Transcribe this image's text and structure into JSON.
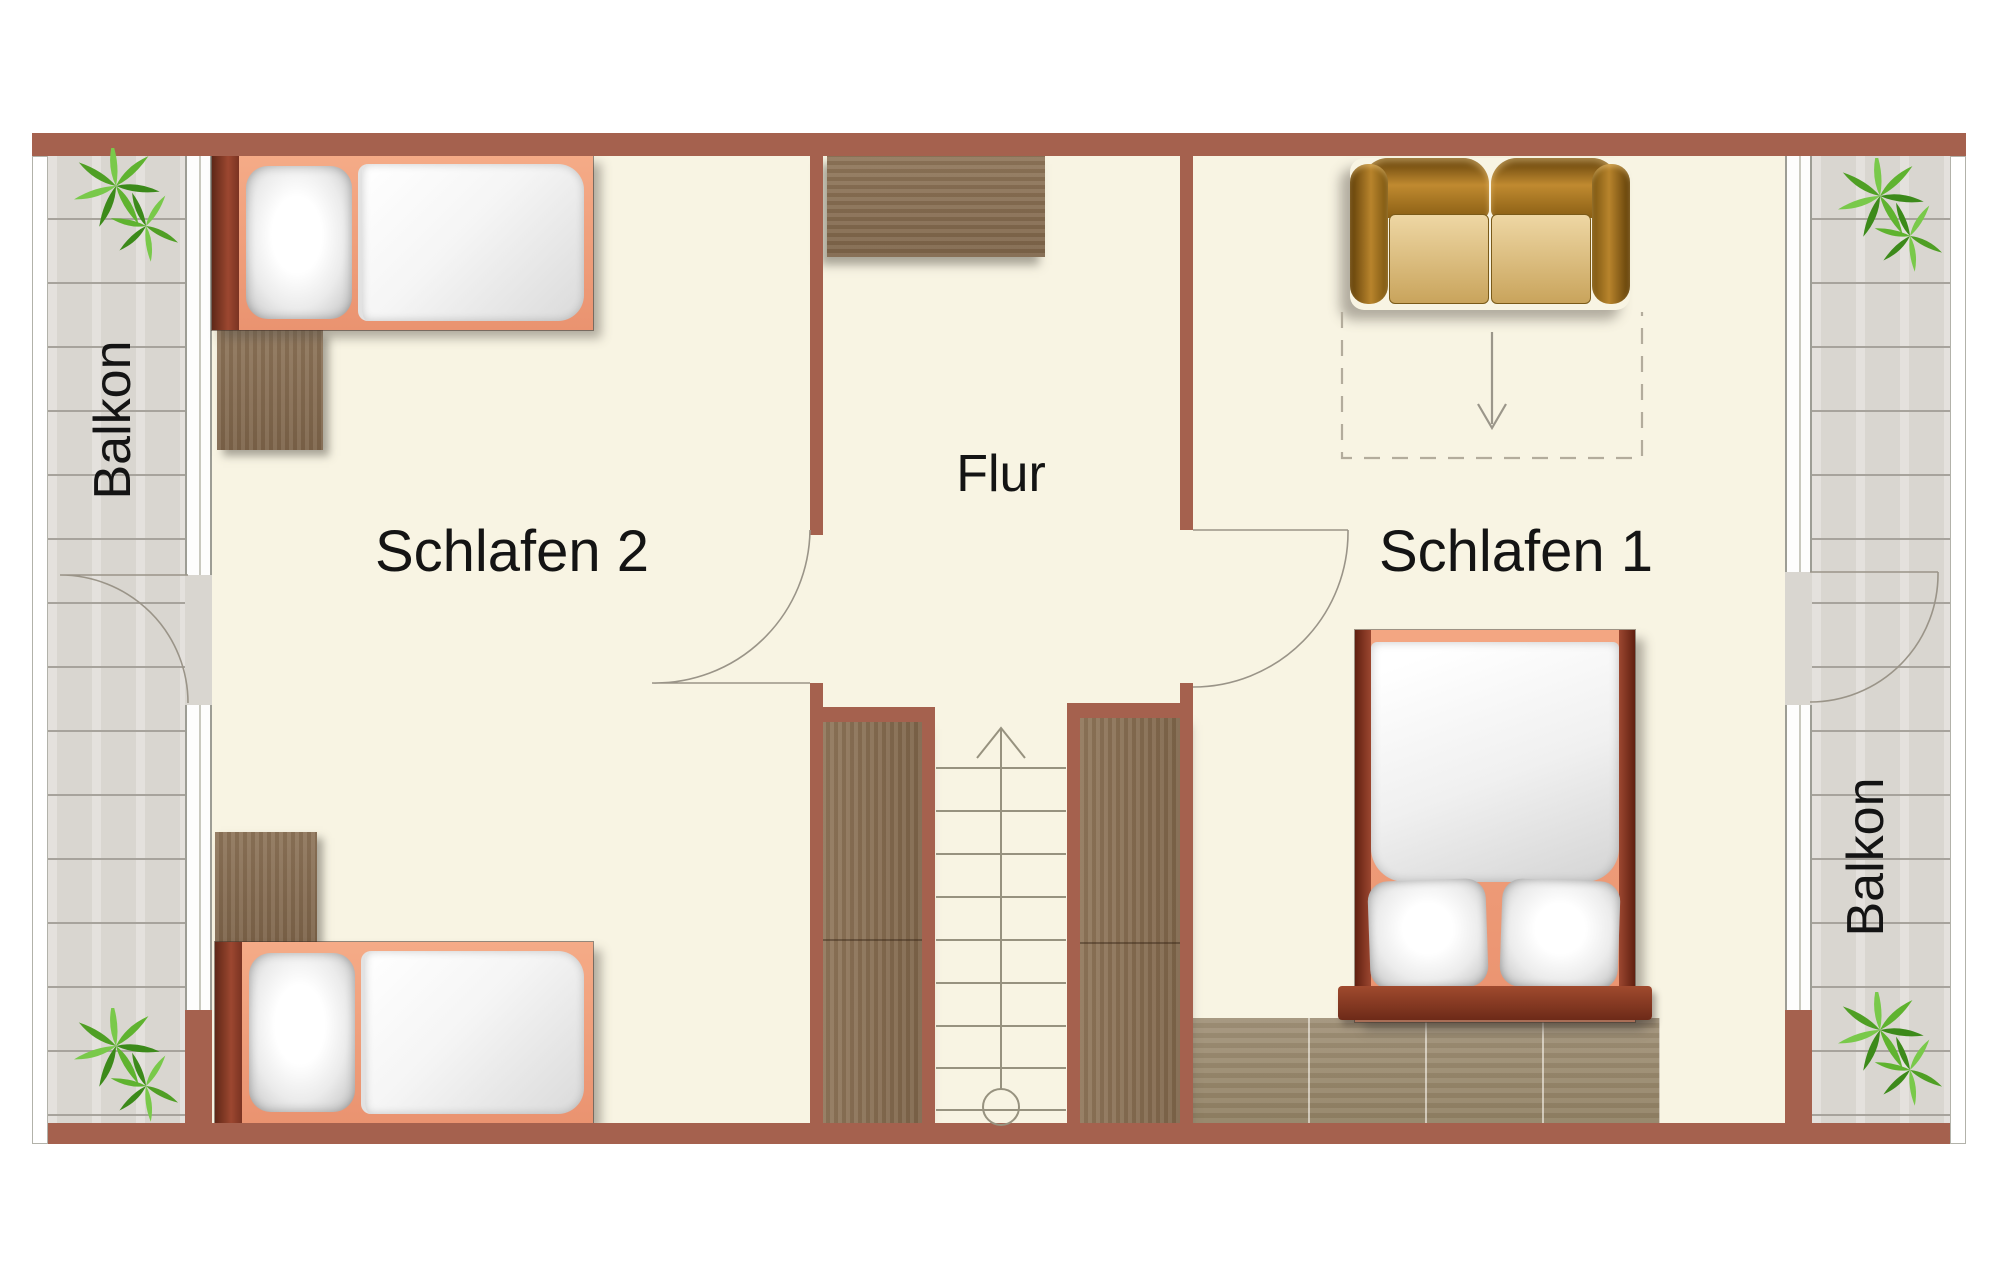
{
  "labels": {
    "bedroom2": "Schlafen 2",
    "bedroom1": "Schlafen 1",
    "hallway": "Flur",
    "balcony_left": "Balkon",
    "balcony_right": "Balkon"
  },
  "icons": {
    "plant": "plant-icon",
    "stairs_up_arrow": "stairs-up-arrow",
    "roof_slope_arrow": "roof-slope-down-arrow"
  },
  "colors": {
    "wall": "#a5614e",
    "wall-dark": "#7e3b28",
    "floor": "#f8f4e3",
    "balcony-plank": "#d9d6d0",
    "balcony-line": "#a7a39c",
    "wood": "#8b7154",
    "wood-light": "#9c8c71",
    "bed-frame": "#ef9a74",
    "bed-rail": "#7e3b28",
    "sofa-dark": "#8a5a14",
    "sofa-light": "#e8cfa0",
    "plant-green": "#4f9f24",
    "line": "#9a9488",
    "text": "#141414"
  }
}
